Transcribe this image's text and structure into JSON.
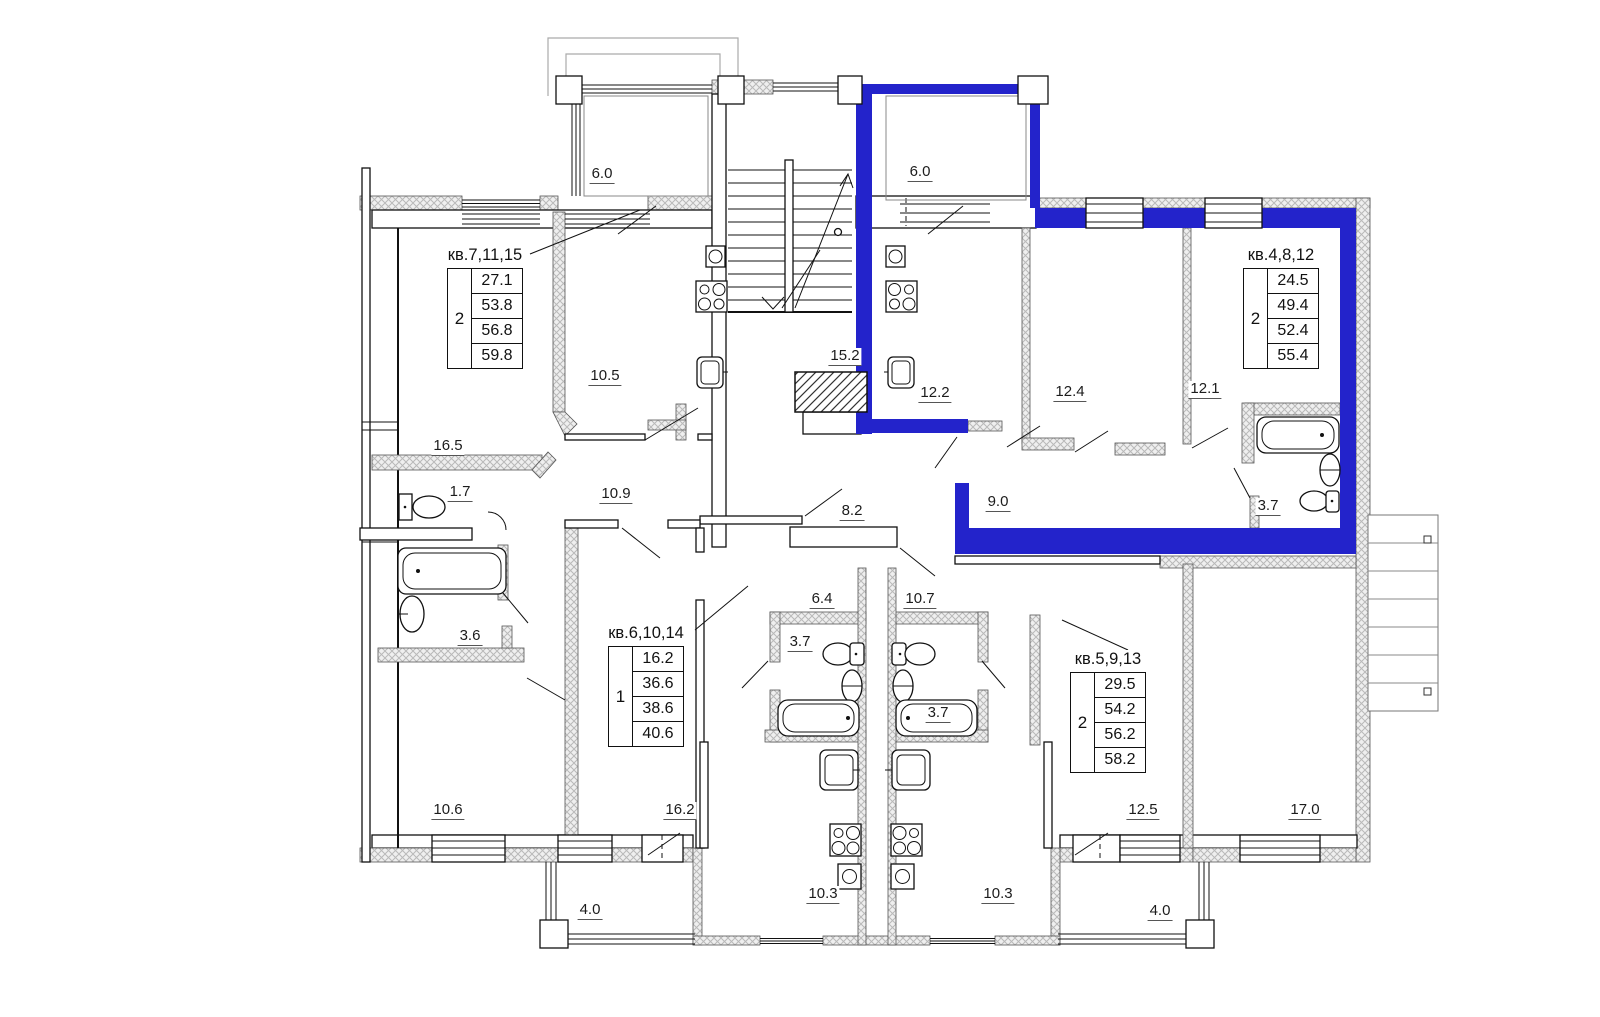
{
  "plan": {
    "highlight_color": "#2323cb",
    "selected_apartment": "кв.4,8,12",
    "apartment_tables": [
      {
        "name": "apt-7-11-15",
        "title": "кв.7,11,15",
        "rooms_count": "2",
        "areas": [
          "27.1",
          "53.8",
          "56.8",
          "59.8"
        ],
        "selected": false
      },
      {
        "name": "apt-4-8-12",
        "title": "кв.4,8,12",
        "rooms_count": "2",
        "areas": [
          "24.5",
          "49.4",
          "52.4",
          "55.4"
        ],
        "selected": true
      },
      {
        "name": "apt-6-10-14",
        "title": "кв.6,10,14",
        "rooms_count": "1",
        "areas": [
          "16.2",
          "36.6",
          "38.6",
          "40.6"
        ],
        "selected": false
      },
      {
        "name": "apt-5-9-13",
        "title": "кв.5,9,13",
        "rooms_count": "2",
        "areas": [
          "29.5",
          "54.2",
          "56.2",
          "58.2"
        ],
        "selected": false
      }
    ],
    "area_labels": [
      {
        "room": "balcony-top-left",
        "value": "6.0"
      },
      {
        "room": "balcony-top-right",
        "value": "6.0"
      },
      {
        "room": "kitchen-10-5",
        "value": "10.5"
      },
      {
        "room": "hall-15-2",
        "value": "15.2"
      },
      {
        "room": "room-12-2",
        "value": "12.2"
      },
      {
        "room": "room-12-4",
        "value": "12.4"
      },
      {
        "room": "room-12-1",
        "value": "12.1"
      },
      {
        "room": "room-16-5",
        "value": "16.5"
      },
      {
        "room": "wc-1-7",
        "value": "1.7"
      },
      {
        "room": "corridor-10-9",
        "value": "10.9"
      },
      {
        "room": "corridor-8-2",
        "value": "8.2"
      },
      {
        "room": "corridor-9-0",
        "value": "9.0"
      },
      {
        "room": "bath-3-7-apt4",
        "value": "3.7"
      },
      {
        "room": "bath-3-6",
        "value": "3.6"
      },
      {
        "room": "hall-6-4",
        "value": "6.4"
      },
      {
        "room": "hall-10-7",
        "value": "10.7"
      },
      {
        "room": "bath-3-7-left",
        "value": "3.7"
      },
      {
        "room": "bath-3-7-right",
        "value": "3.7"
      },
      {
        "room": "room-10-6",
        "value": "10.6"
      },
      {
        "room": "room-16-2",
        "value": "16.2"
      },
      {
        "room": "room-12-5",
        "value": "12.5"
      },
      {
        "room": "room-17-0",
        "value": "17.0"
      },
      {
        "room": "kitchen-10-3-left",
        "value": "10.3"
      },
      {
        "room": "kitchen-10-3-right",
        "value": "10.3"
      },
      {
        "room": "balcony-4-0-left",
        "value": "4.0"
      },
      {
        "room": "balcony-4-0-right",
        "value": "4.0"
      }
    ]
  }
}
